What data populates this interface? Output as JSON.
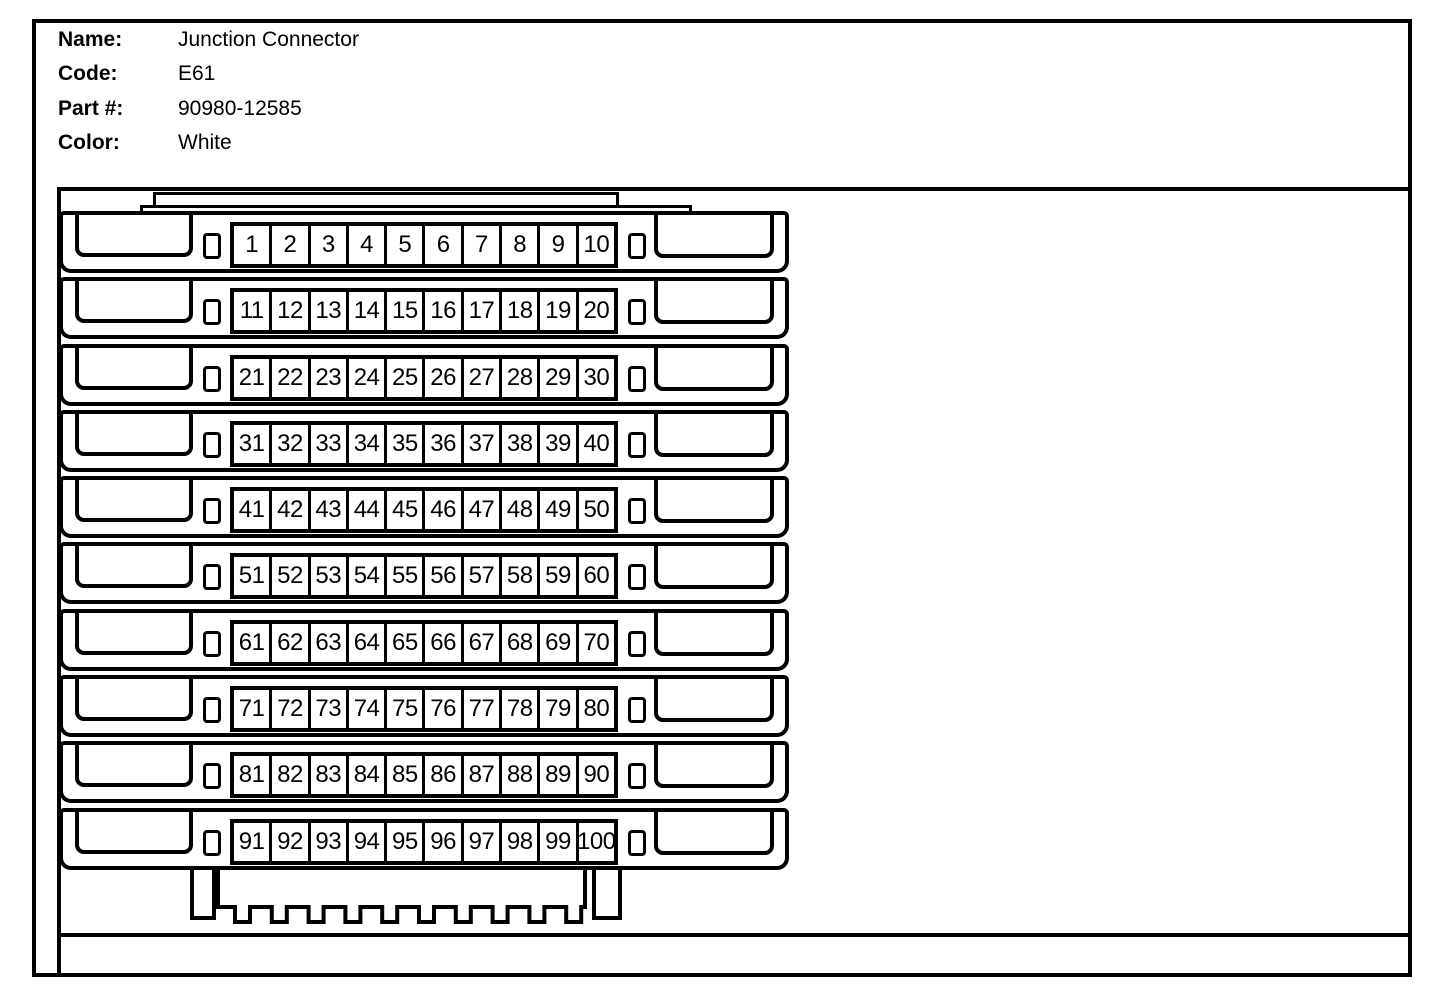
{
  "page": {
    "paper": "#ffffff",
    "ink": "#000000"
  },
  "header": {
    "fields": [
      {
        "label": "Name:",
        "value": "Junction Connector"
      },
      {
        "label": "Code:",
        "value": "E61"
      },
      {
        "label": "Part #:",
        "value": "90980-12585"
      },
      {
        "label": "Color:",
        "value": "White"
      }
    ]
  },
  "connector": {
    "pin_rows": [
      [
        1,
        2,
        3,
        4,
        5,
        6,
        7,
        8,
        9,
        10
      ],
      [
        11,
        12,
        13,
        14,
        15,
        16,
        17,
        18,
        19,
        20
      ],
      [
        21,
        22,
        23,
        24,
        25,
        26,
        27,
        28,
        29,
        30
      ],
      [
        31,
        32,
        33,
        34,
        35,
        36,
        37,
        38,
        39,
        40
      ],
      [
        41,
        42,
        43,
        44,
        45,
        46,
        47,
        48,
        49,
        50
      ],
      [
        51,
        52,
        53,
        54,
        55,
        56,
        57,
        58,
        59,
        60
      ],
      [
        61,
        62,
        63,
        64,
        65,
        66,
        67,
        68,
        69,
        70
      ],
      [
        71,
        72,
        73,
        74,
        75,
        76,
        77,
        78,
        79,
        80
      ],
      [
        81,
        82,
        83,
        84,
        85,
        86,
        87,
        88,
        89,
        90
      ],
      [
        91,
        92,
        93,
        94,
        95,
        96,
        97,
        98,
        99,
        100
      ]
    ]
  }
}
